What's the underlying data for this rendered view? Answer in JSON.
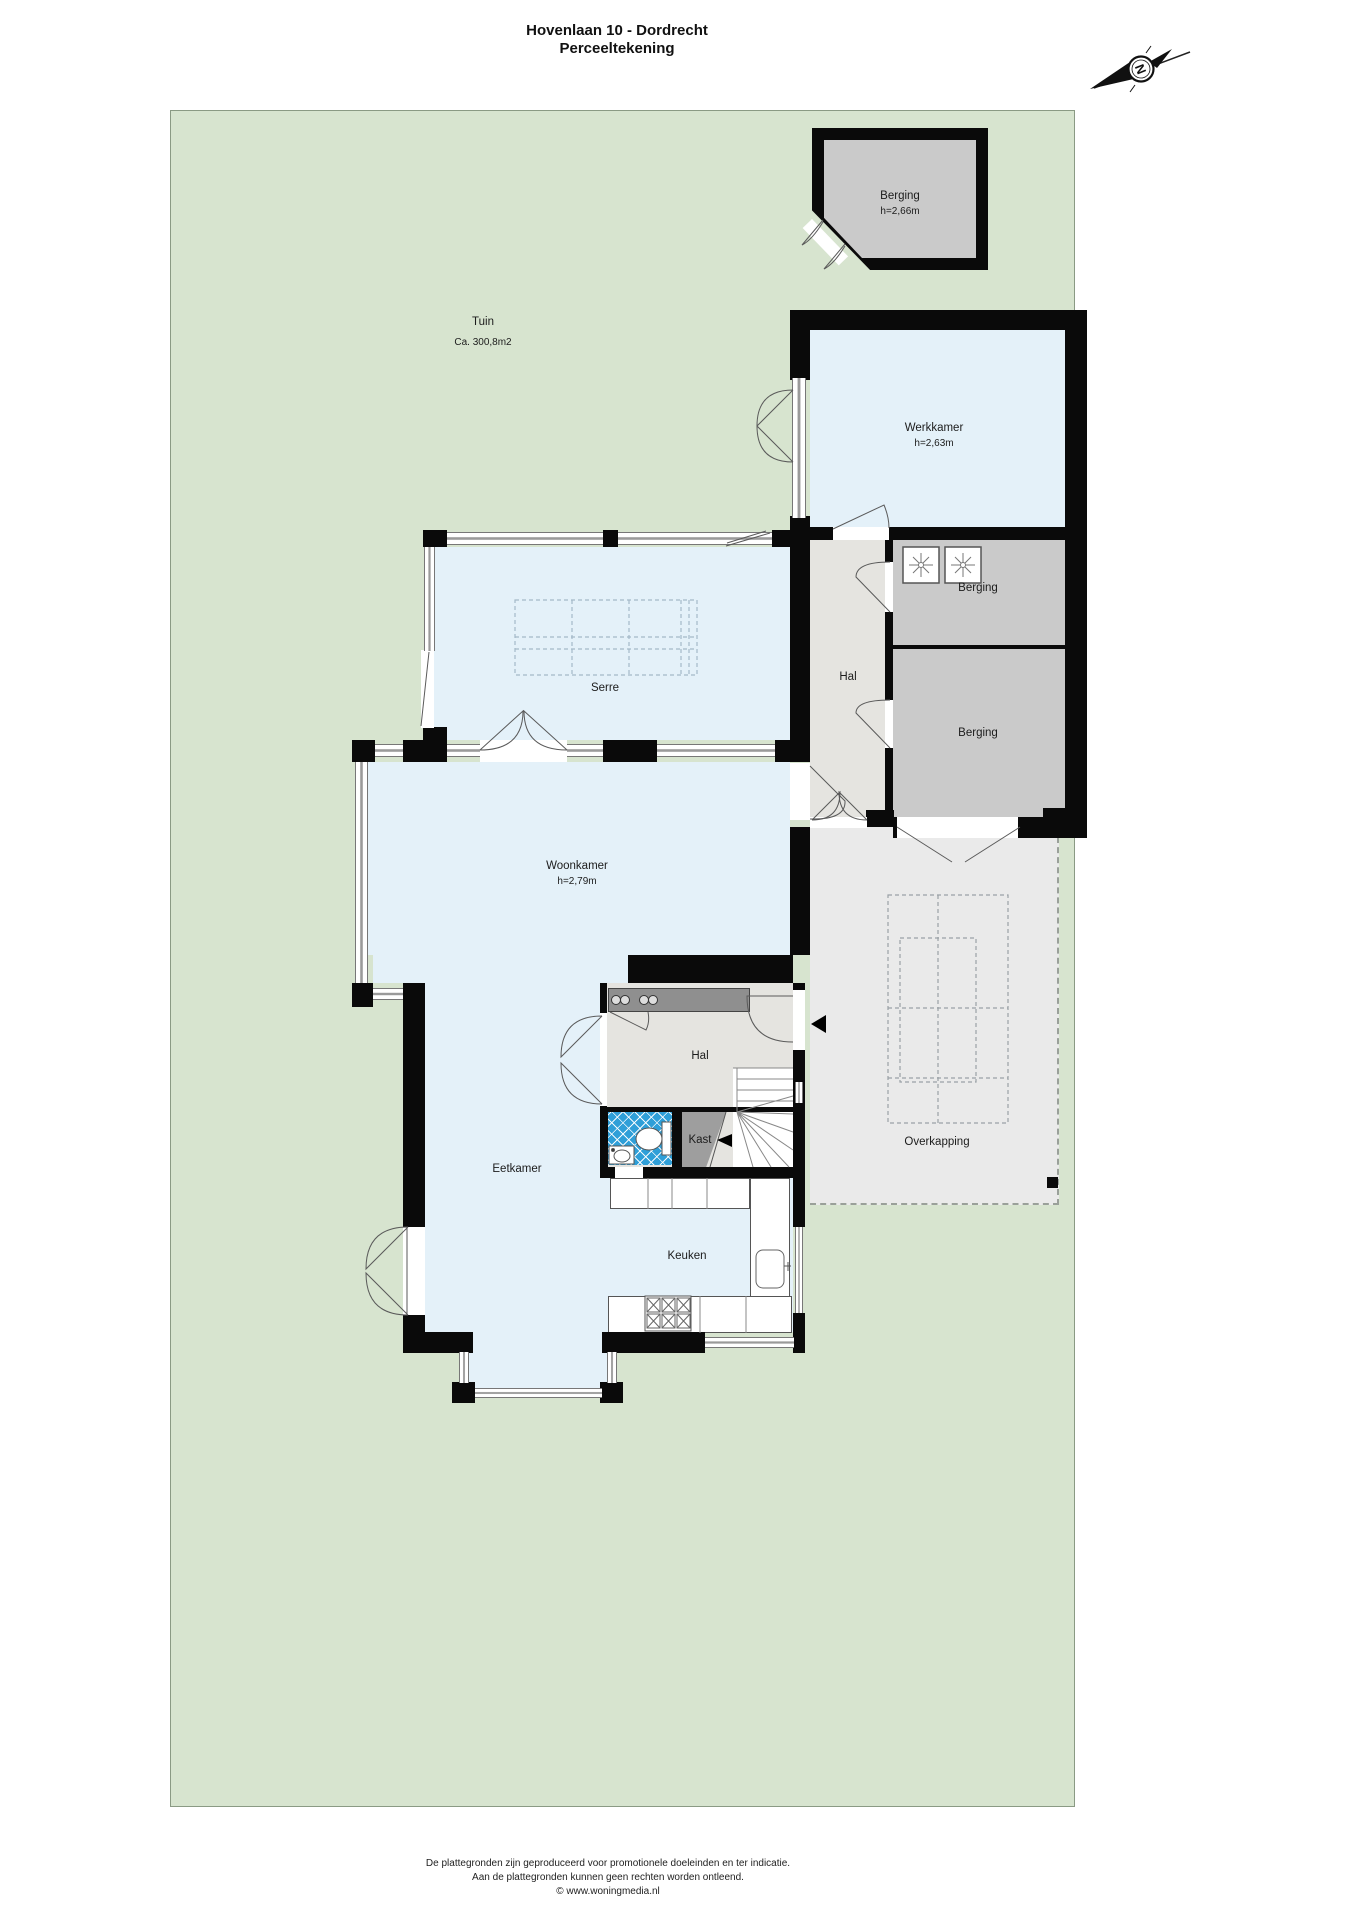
{
  "title": {
    "line1": "Hovenlaan 10 - Dordrecht",
    "line2": "Perceeltekening"
  },
  "compass": {
    "letter": "N"
  },
  "garden": {
    "label": "Tuin",
    "area": "Ca. 300,8m2"
  },
  "rooms": {
    "berging_tuin": {
      "label": "Berging",
      "height": "h=2,66m"
    },
    "werkkamer": {
      "label": "Werkkamer",
      "height": "h=2,63m"
    },
    "hal_achter": {
      "label": "Hal"
    },
    "berging_was": {
      "label": "Berging"
    },
    "berging_2": {
      "label": "Berging"
    },
    "serre": {
      "label": "Serre"
    },
    "woonkamer": {
      "label": "Woonkamer",
      "height": "h=2,79m"
    },
    "hal_entree": {
      "label": "Hal"
    },
    "kast": {
      "label": "Kast"
    },
    "eetkamer": {
      "label": "Eetkamer"
    },
    "keuken": {
      "label": "Keuken"
    },
    "overkapping": {
      "label": "Overkapping"
    }
  },
  "footer": {
    "line1": "De plattegronden zijn geproduceerd voor promotionele doeleinden en ter indicatie.",
    "line2": "Aan de plattegronden kunnen geen rechten worden ontleend.",
    "line3": "© www.woningmedia.nl"
  },
  "colors": {
    "wall": "#0a0a0a",
    "garden": "#d7e4cf",
    "room": "#e4f1f9",
    "hall": "#e5e4e0",
    "storage": "#cacaca",
    "overkapping": "#eaeaea",
    "tile": "#2f9fd8",
    "closet": "#9e9e9e",
    "sideboard": "#8f8f8f"
  }
}
